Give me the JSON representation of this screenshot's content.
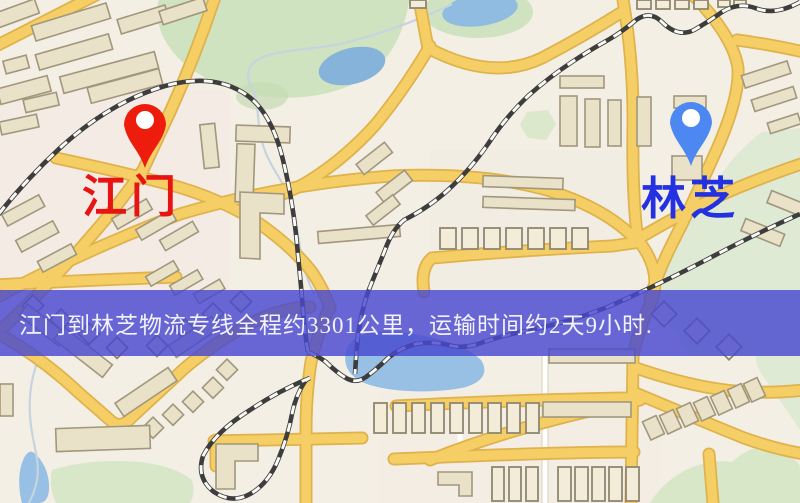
{
  "map": {
    "markers": {
      "origin": {
        "label": "江门",
        "pin_icon": "map-pin-icon",
        "pin_color": "#ed1c0d",
        "label_color": "#e81313"
      },
      "destination": {
        "label": "林芝",
        "pin_icon": "map-pin-icon",
        "pin_color": "#4c87f2",
        "label_color": "#2431e0"
      }
    },
    "colors": {
      "background": "#f3efe5",
      "road": "#f5cf66",
      "road_casing": "#dfb24c",
      "railway": "#3d3d3d",
      "water": "#8fbadf",
      "park": "#cfe3c0",
      "building": "#e9e1c8"
    }
  },
  "banner": {
    "text": "江门到林芝物流专线全程约3301公里，运输时间约2天9小时.",
    "origin": "江门",
    "destination": "林芝",
    "distance_km": "3301",
    "duration": "2天9小时",
    "background_color": "rgba(72,72,208,0.82)",
    "text_color": "#f2f2fa"
  }
}
